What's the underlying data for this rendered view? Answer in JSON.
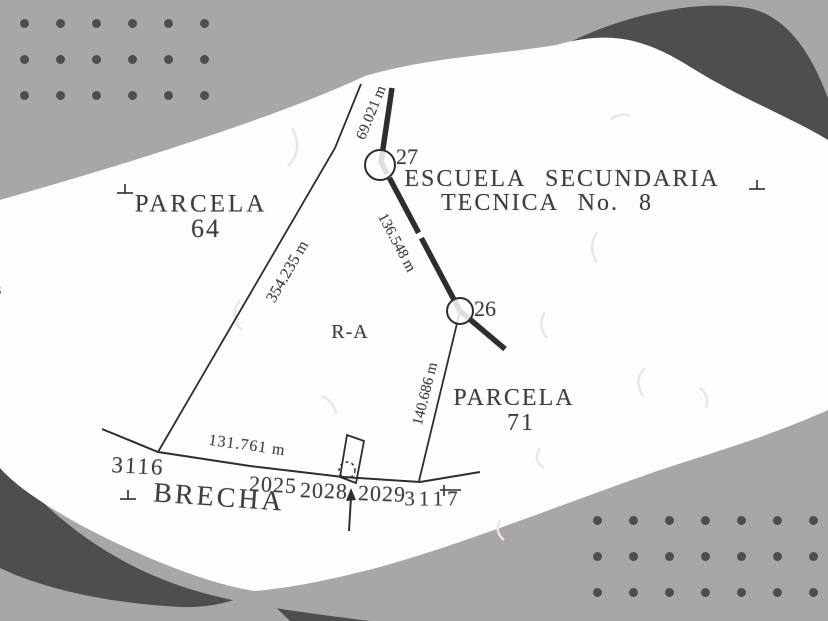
{
  "colors": {
    "background": "#a7a7a7",
    "dark_shape": "#4e4e4e",
    "paper": "#fdfdfd",
    "ink": "#3d3d3d",
    "dots": "#4e4e4e"
  },
  "plan": {
    "parcels": {
      "parcela_64": {
        "name": "PARCELA",
        "number": "64"
      },
      "parcela_71": {
        "name": "PARCELA",
        "number": "71"
      },
      "school": {
        "line1": "ESCUELA SECUNDARIA",
        "line2": "TECNICA No. 8"
      },
      "area_code": "R-A",
      "road": "BRECHA"
    },
    "measurements": {
      "m69": "69.021 m",
      "m136": "136.548 m",
      "m140": "140.686 m",
      "m354": "354.235 m",
      "m131": "131.761 m"
    },
    "vertices": {
      "v27": "27",
      "v26": "26"
    },
    "stations": {
      "s3116": "3116",
      "s2025": "2025",
      "s2028": "2028",
      "s2029": "2029",
      "s3117": "3117"
    },
    "edge_fragment": "s"
  },
  "decor": {
    "dot_grids": [
      {
        "id": "top-left",
        "x": 24,
        "y": 23,
        "cols": 6,
        "rows": 3,
        "spacing": 36
      },
      {
        "id": "bottom-right",
        "x": 597,
        "y": 520,
        "cols": 7,
        "rows": 3,
        "spacing": 36
      }
    ]
  }
}
